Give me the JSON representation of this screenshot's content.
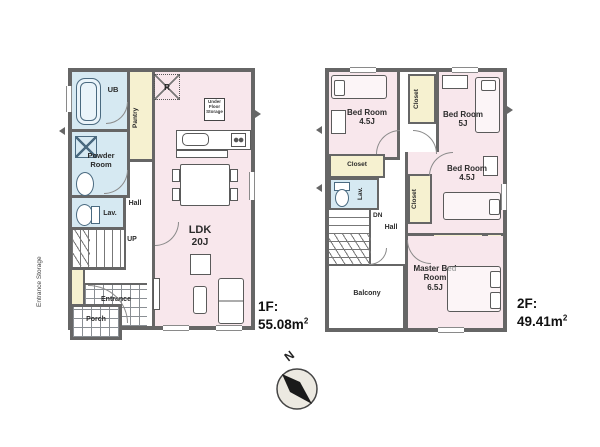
{
  "colors": {
    "wall": "#666666",
    "room_pink": "#f8e7ec",
    "wet_area_blue": "#d6e9f2",
    "storage_yellow": "#f6f1d0",
    "compass_fill": "#ece9e1",
    "needle_black": "#1a1a1a"
  },
  "f1": {
    "area_label": "1F:",
    "area_value": "55.08",
    "area_unit": "m",
    "area_sup": "2",
    "ub": "UB",
    "pantry": "Pantry",
    "powder_room": "Powder Room",
    "lav": "Lav.",
    "hall": "Hall",
    "up": "UP",
    "ldk_name": "LDK",
    "ldk_size": "20J",
    "fridge": "R",
    "under_floor": "Under Floor Storage",
    "entrance": "Entrance",
    "porch": "Porch",
    "entrance_storage": "Entrance Storage"
  },
  "f2": {
    "area_label": "2F:",
    "area_value": "49.41",
    "area_unit": "m",
    "area_sup": "2",
    "bed1_name": "Bed Room",
    "bed1_size": "4.5J",
    "bed2_name": "Bed Room",
    "bed2_size": "5J",
    "bed3_name": "Bed Room",
    "bed3_size": "4.5J",
    "master_name": "Master Bed Room",
    "master_size": "6.5J",
    "closet_top": "Closet",
    "closet_left": "Closet",
    "closet_mid": "Closet",
    "closet_a": "Closet",
    "closet_b": "Closet",
    "lav": "Lav.",
    "dn": "DN",
    "hall": "Hall",
    "balcony": "Balcony"
  },
  "compass": {
    "north": "N"
  }
}
